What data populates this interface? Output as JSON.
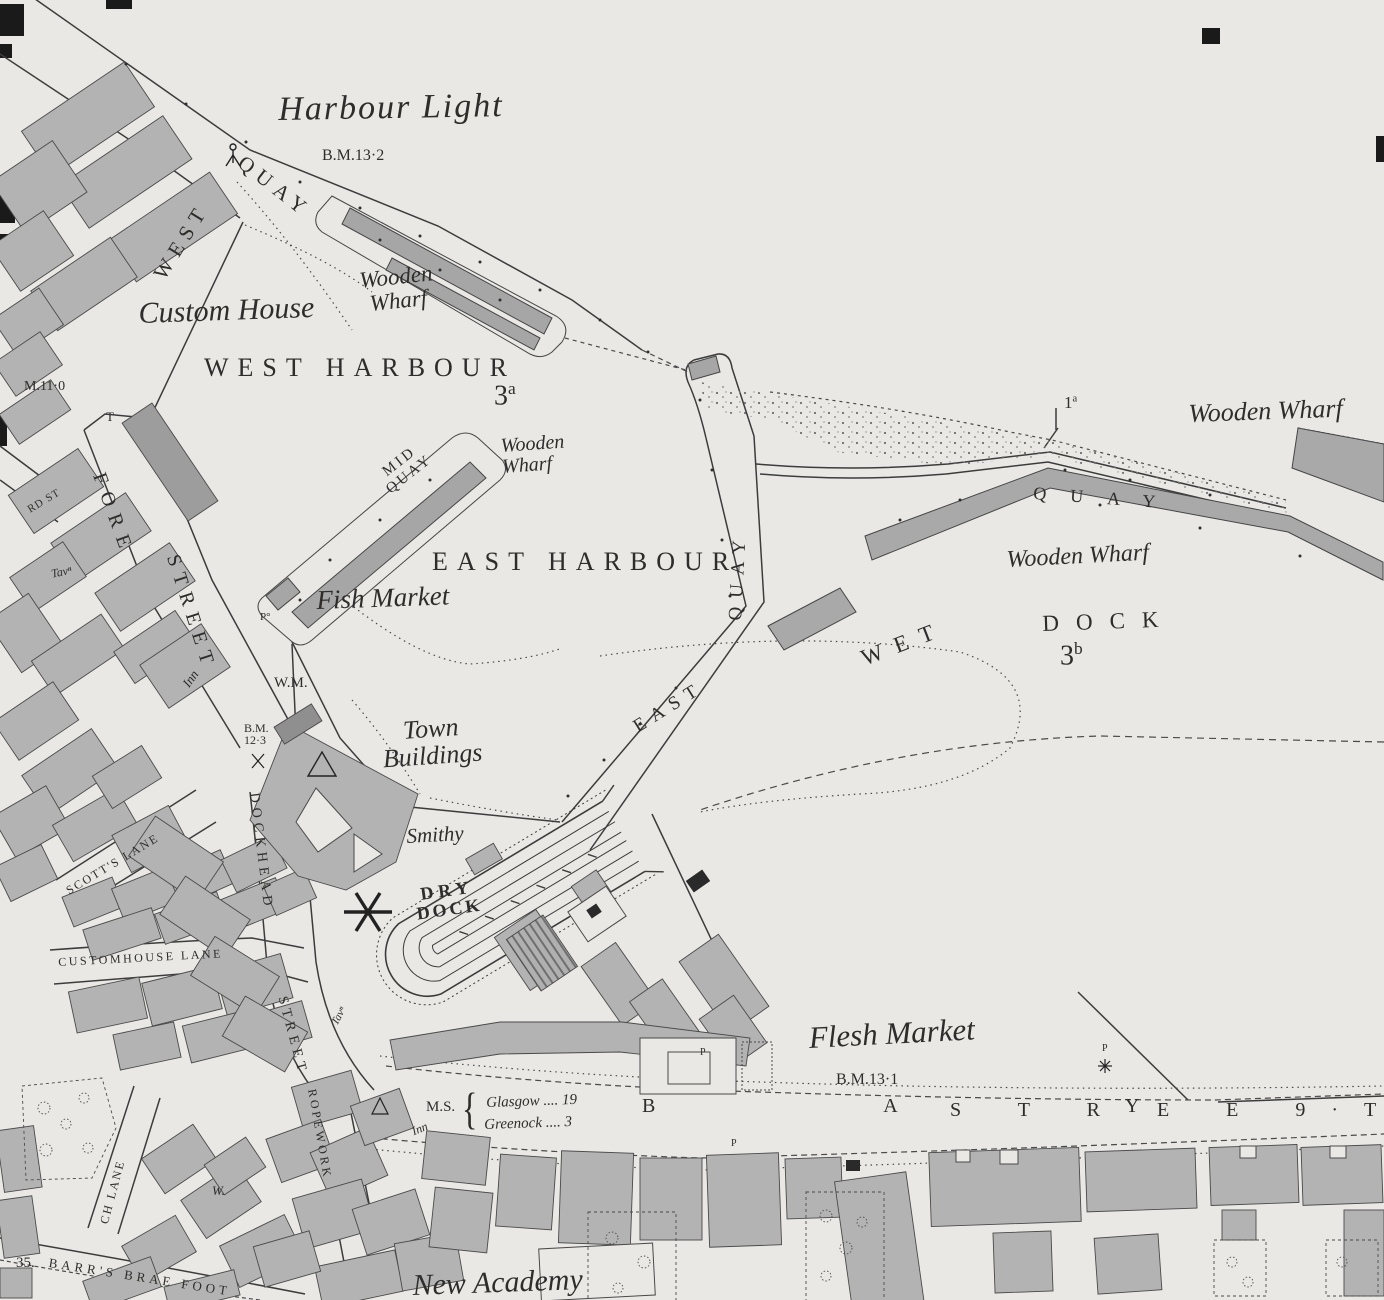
{
  "colors": {
    "paper": "#e9e8e5",
    "ink": "#3c3c3c",
    "building": "#b3b3b3",
    "building_dark": "#9d9d9d",
    "black": "#1a1a1a"
  },
  "map_title": "Harbour town plan (scanned Ordnance Survey sheet)",
  "labels": {
    "harbour_light": "Harbour Light",
    "bm_13_2": "B.M.13·2",
    "west": "WEST",
    "quay_w": "QUAY",
    "custom_house": "Custom House",
    "wooden_wharf_a1": "Wooden",
    "wooden_wharf_a2": "Wharf",
    "west_harbour": "WEST HARBOUR",
    "ref_3a_base": "3",
    "ref_3a_sup": "a",
    "wooden_wharf_b1": "Wooden",
    "wooden_wharf_b2": "Wharf",
    "mid": "MID",
    "mid_quay": "QUAY",
    "east_harbour": "EAST HARBOUR",
    "fish_market": "Fish Market",
    "east": "EAST",
    "east_quay": "QUAY",
    "quay_n": "QUAY",
    "wooden_wharf_c": "Wooden Wharf",
    "wooden_wharf_d": "Wooden Wharf",
    "ref_1a_base": "1",
    "ref_1a_sup": "a",
    "wet": "WET",
    "dock": "DOCK",
    "ref_3b_base": "3",
    "ref_3b_sup": "b",
    "town_1": "Town",
    "town_2": "Buildings",
    "smithy": "Smithy",
    "dry": "DRY",
    "dry_dock": "DOCK",
    "flesh_market": "Flesh Market",
    "bm_13_1": "B.M.13·1",
    "new_academy": "New Academy",
    "fore": "FORE",
    "fore_street": "STREET",
    "dockhead": "DOCKHEAD",
    "dockhead_street": "STREET",
    "customhouse_lane": "CUSTOMHOUSE LANE",
    "scotts_lane": "SCOTT'S LANE",
    "ropework": "ROPEWORK",
    "ch_lane": "CH LANE",
    "barrs_brae_foot": "BARR'S BRAE FOOT",
    "bay": "B A Y",
    "street_seq": "S T R E E 9·T",
    "ms": "M.S.",
    "brace": "{",
    "glasgow_line": "Glasgow .... 19",
    "greenock_line": "Greenock .... 3",
    "rd_st": "RD ST",
    "bm_11_0": "M.11·0",
    "t_mark": "T",
    "tav_1": "Tavⁿ",
    "tav_2": "Tavⁿ",
    "inn_1": "Inn",
    "inn_2": "Inn",
    "wm": "W.M.",
    "bm_12_3a": "B.M.",
    "bm_12_3b": "12·3",
    "p_deg": "P°",
    "p_1": "P",
    "p_2": "P",
    "p_3": "P",
    "w_well": "W.",
    "num_35": "35."
  }
}
